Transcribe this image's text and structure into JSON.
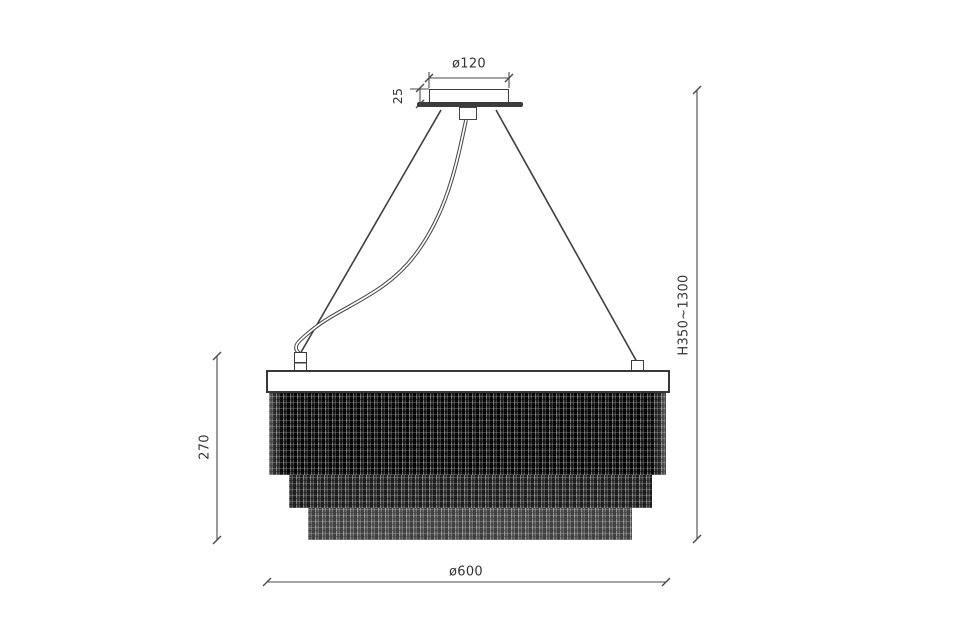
{
  "drawing": {
    "type": "technical-dimension-drawing",
    "subject": "crystal chain pendant chandelier, front elevation",
    "colors": {
      "background": "#ffffff",
      "line": "#424242",
      "text": "#333333",
      "chain_dark": "#161616"
    },
    "labels": {
      "canopy_diameter": "ø120",
      "canopy_height": "25",
      "hanging_height": "H350~1300",
      "body_height": "270",
      "body_diameter": "ø600"
    }
  }
}
